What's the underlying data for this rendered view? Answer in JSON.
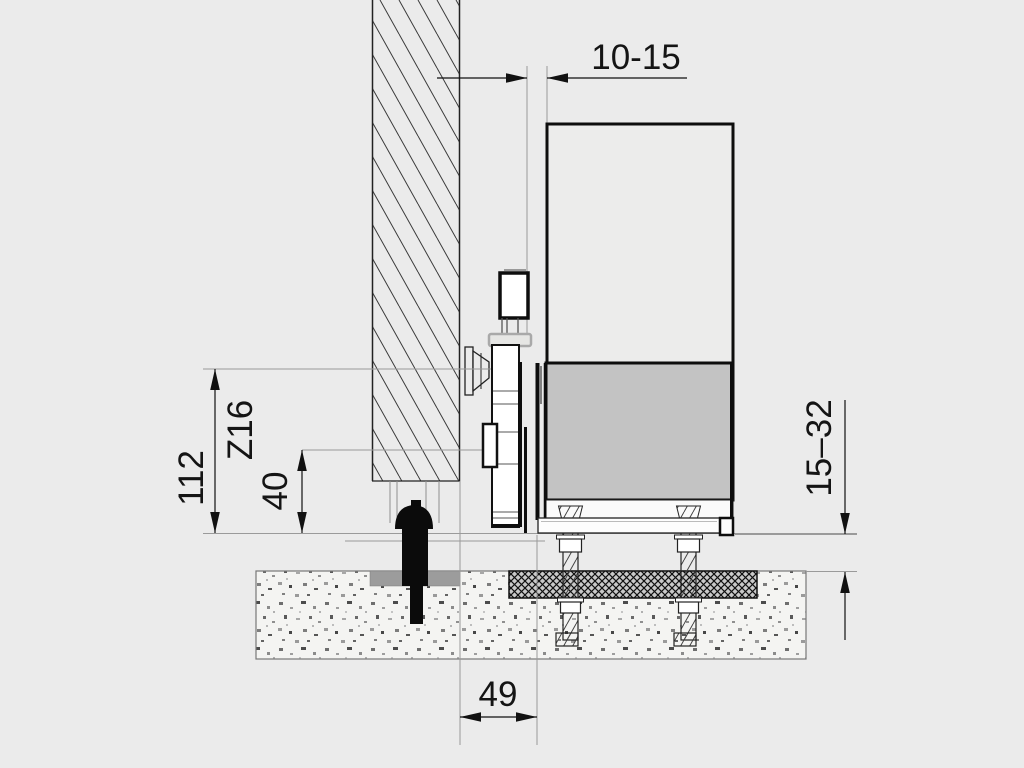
{
  "diagram": {
    "type": "technical-section-drawing",
    "dimension_labels": {
      "top_gap": "10-15",
      "pinion_height": "112",
      "pinion_designation": "Z16",
      "rack_bottom_height": "40",
      "height_adjustment_range": "15–32",
      "post_to_front_distance": "49"
    },
    "colors": {
      "background": "#ebebeb",
      "line_dark": "#111111",
      "line_gray": "#9a9a9a",
      "motor_body_fill": "#c3c3c3",
      "cover_fill": "#ececeb",
      "foundation_plate_fill": "#9c9c9c"
    }
  }
}
